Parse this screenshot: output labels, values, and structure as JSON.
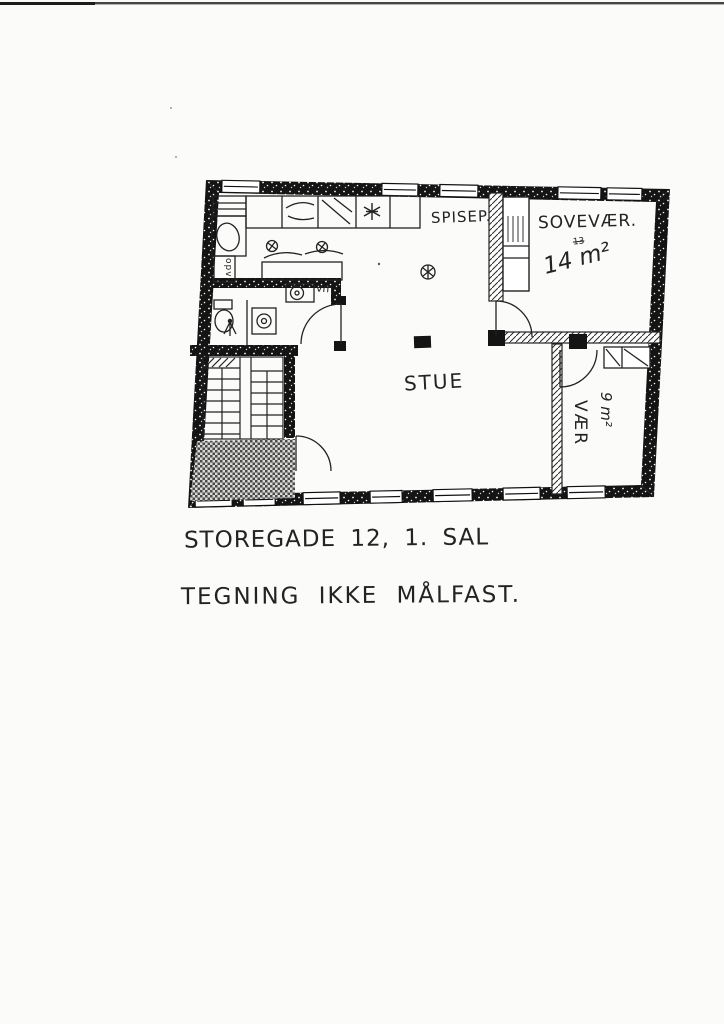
{
  "floor_plan": {
    "rooms": [
      {
        "name": "SPISEP."
      },
      {
        "name": "SOVEVÆR.",
        "area": "14 m²",
        "note": "13"
      },
      {
        "name": "STUE"
      },
      {
        "name": "VÆR",
        "area": "9 m²"
      }
    ],
    "appliance_labels": {
      "washing_machine": "vm",
      "dishwasher": "opv"
    }
  },
  "captions": {
    "address": "STOREGADE 12, 1. SAL",
    "disclaimer": "TEGNING IKKE MÅLFAST."
  },
  "colors": {
    "paper": "#fbfbf9",
    "ink": "#232323",
    "wall": "#141414",
    "checker": "#4a4a4a"
  }
}
